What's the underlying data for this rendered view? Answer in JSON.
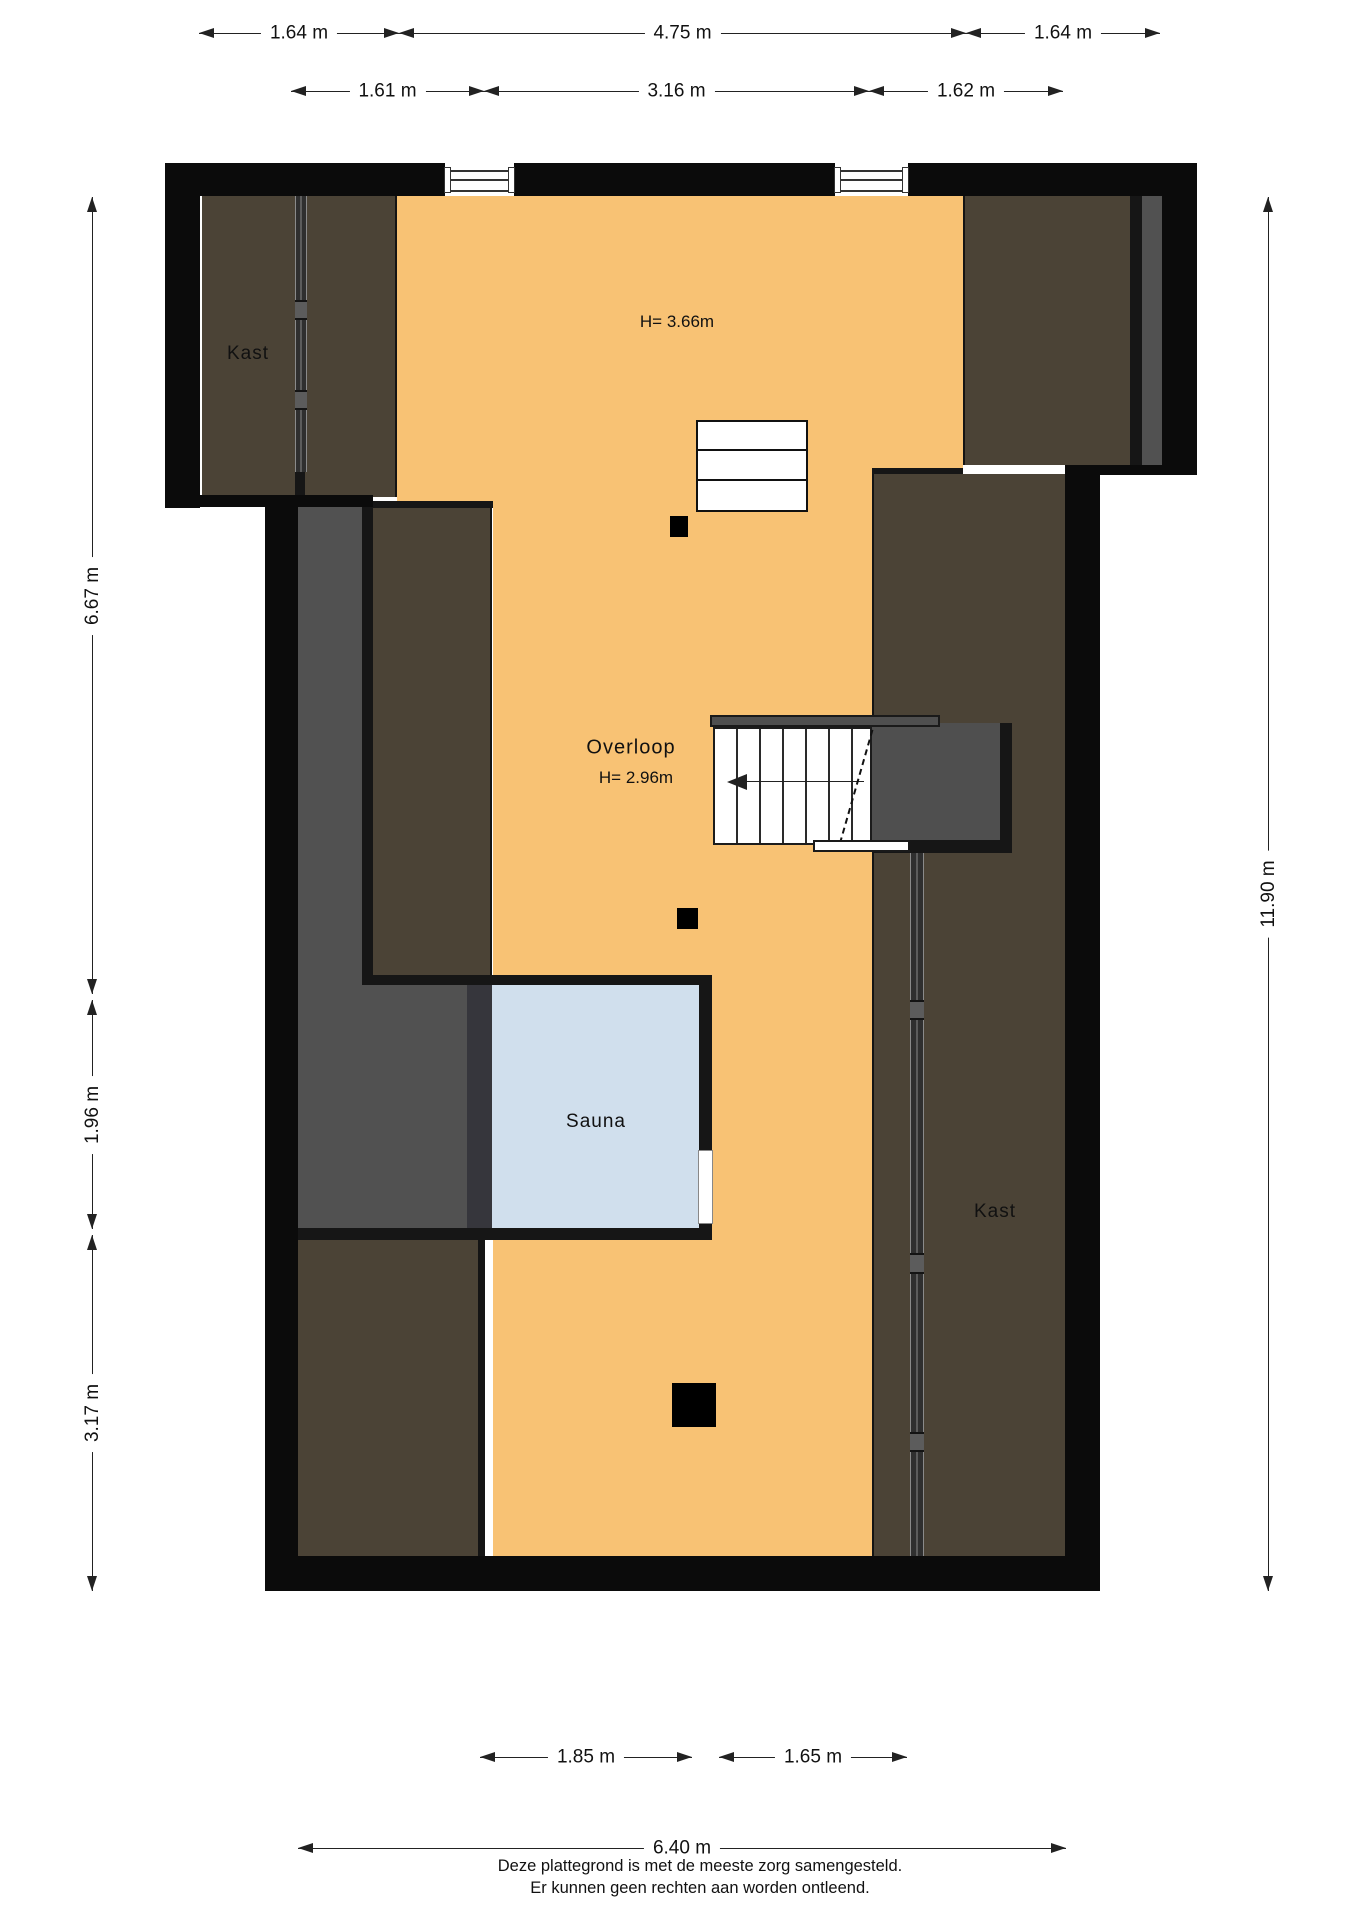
{
  "meta": {
    "type": "floorplan",
    "language": "nl"
  },
  "colors": {
    "floor": "#f8c274",
    "roof": "#4b4336",
    "gray": "#515151",
    "landing": "#4f4f4f",
    "sauna": "#d0dfed",
    "wall": "#0b0b0b",
    "inner": "#161616",
    "track": "#2f2f2f",
    "line": "#222222",
    "text": "#111111"
  },
  "rooms": {
    "kast_top_left": {
      "label": "Kast"
    },
    "kast_right": {
      "label": "Kast"
    },
    "overloop": {
      "label": "Overloop",
      "height_note": "H= 2.96m"
    },
    "open_space": {
      "height_note": "H= 3.66m"
    },
    "sauna": {
      "label": "Sauna"
    }
  },
  "dimensions": {
    "top_row_outer": [
      "1.64 m",
      "4.75 m",
      "1.64 m"
    ],
    "top_row_inner": [
      "1.61 m",
      "3.16 m",
      "1.62 m"
    ],
    "bottom_row_inner": [
      "1.85 m",
      "1.65 m"
    ],
    "bottom_row_outer": [
      "6.40 m"
    ],
    "left_column": [
      "6.67 m",
      "1.96 m",
      "3.17 m"
    ],
    "right_column": [
      "11.90 m"
    ]
  },
  "footer": {
    "line1": "Deze plattegrond is met de meeste zorg samengesteld.",
    "line2": "Er kunnen geen rechten aan worden ontleend."
  }
}
